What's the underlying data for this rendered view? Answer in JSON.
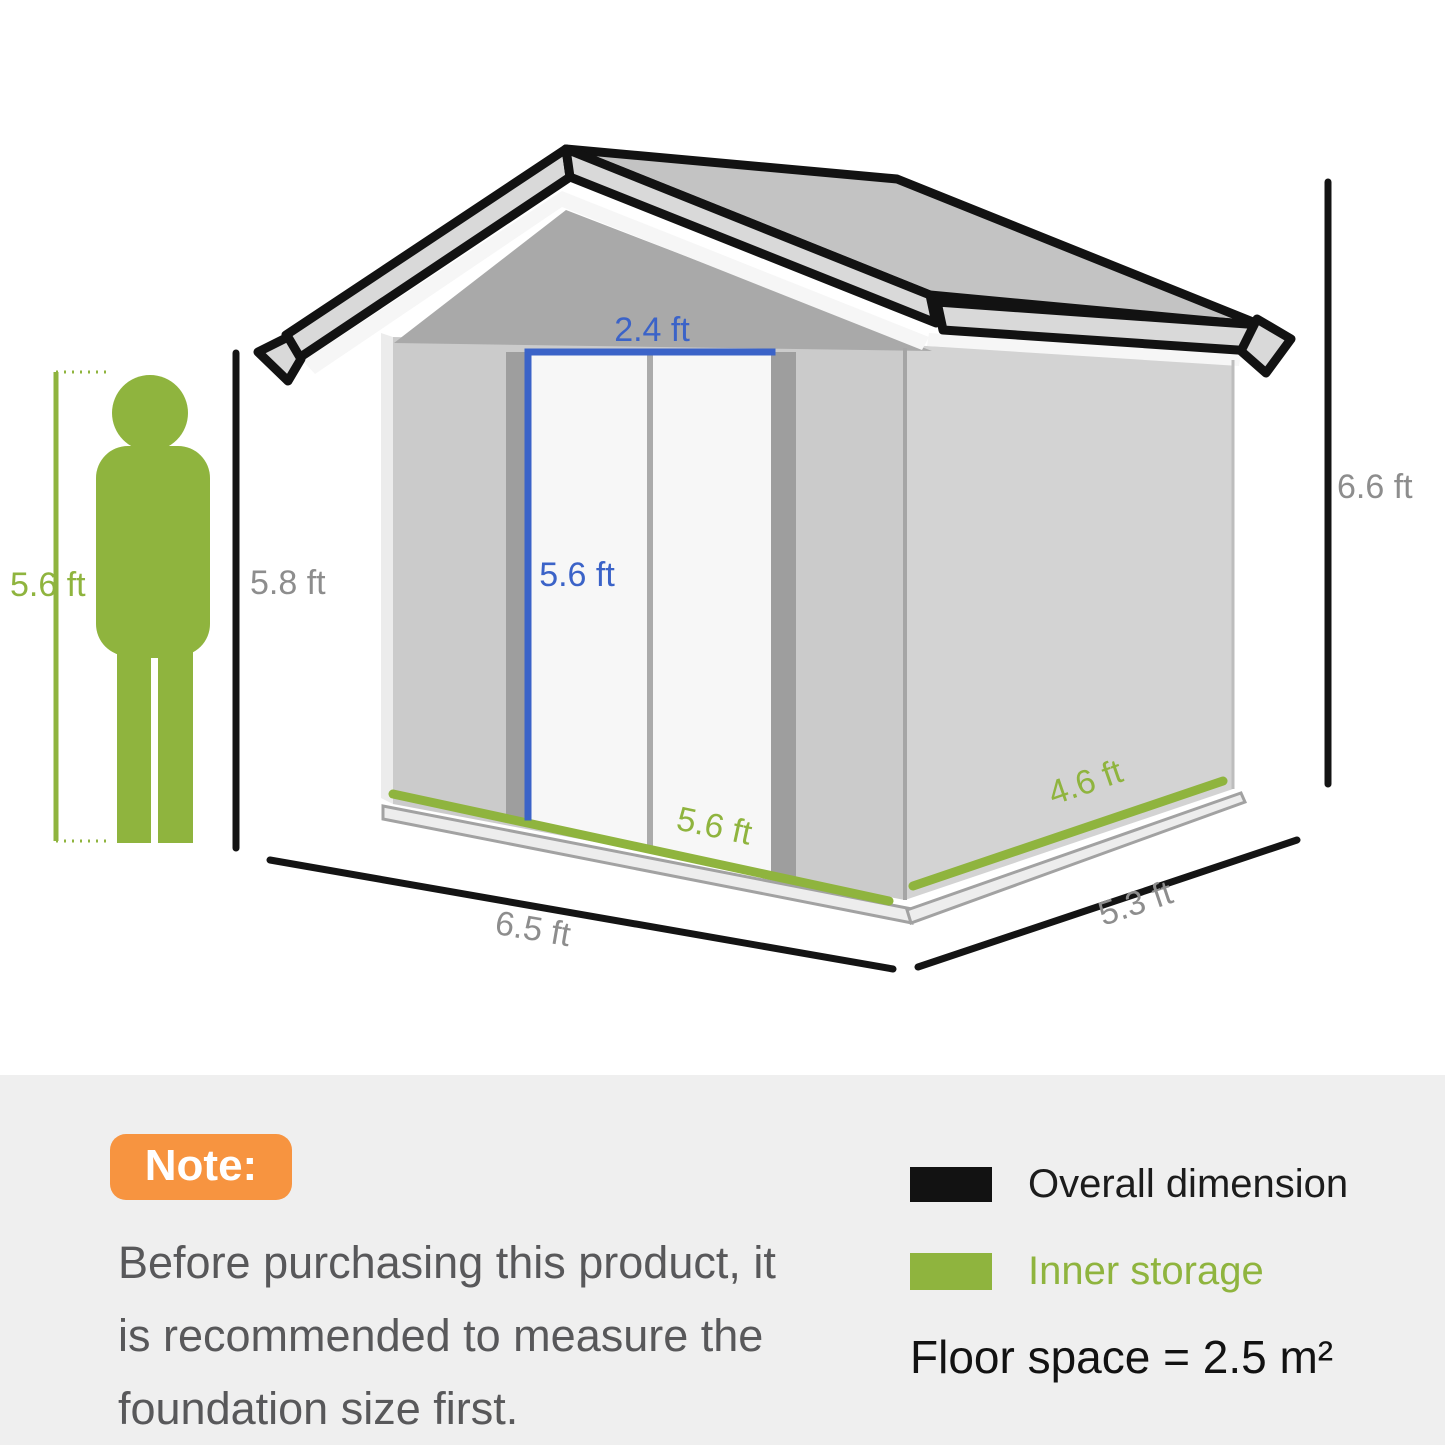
{
  "colors": {
    "inner_storage_green": "#8fb43e",
    "door_dimension_blue": "#3b63c8",
    "overall_dimension_black": "#121212",
    "note_badge_orange": "#f79440",
    "dimension_label_gray": "#8d8d8d",
    "band_gray": "#efefef"
  },
  "shed": {
    "door_width_label": "2.4 ft",
    "door_height_label": "5.6 ft",
    "inner_width_label": "5.6 ft",
    "inner_depth_label": "4.6 ft",
    "overall_width_label": "6.5 ft",
    "overall_depth_label": "5.3 ft",
    "eave_height_label": "5.8 ft",
    "overall_height_label": "6.6 ft"
  },
  "person": {
    "height_label": "5.6 ft"
  },
  "note": {
    "badge_label": "Note:",
    "lines": [
      "Before purchasing this product, it",
      "is recommended to measure the",
      "foundation size first."
    ]
  },
  "legend": {
    "overall_label": "Overall dimension",
    "inner_label": "Inner storage",
    "floor_space_label": "Floor space = 2.5 m²"
  }
}
